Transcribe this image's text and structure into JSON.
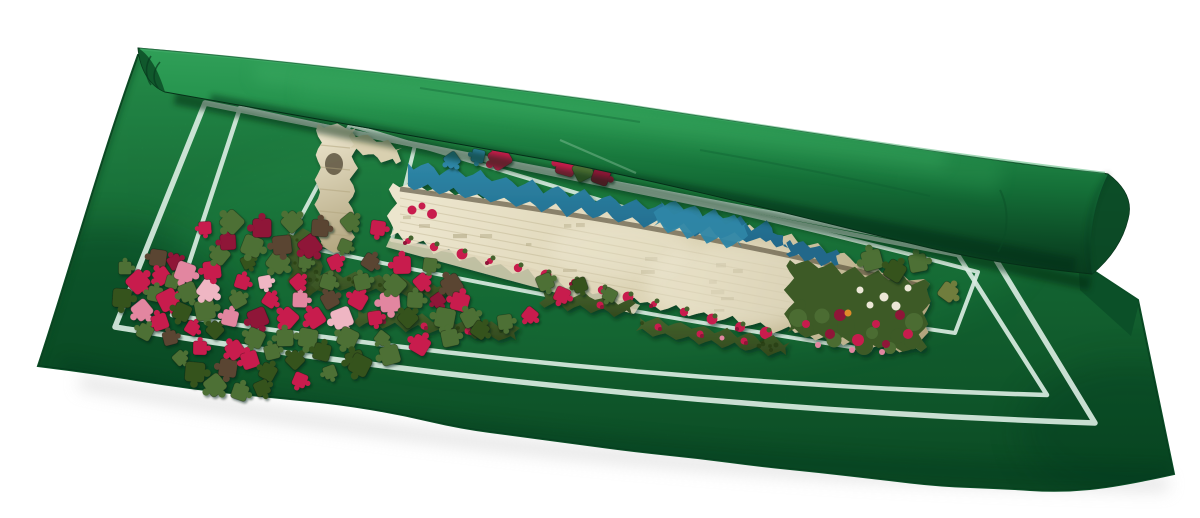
{
  "scene": {
    "kind": "product-photograph",
    "background": "#ffffff",
    "colors": {
      "mat": "#17763a",
      "matLight": "#2aa054",
      "matDark": "#0d5429",
      "matEdge": "#0a4a23",
      "rollTop": "#34a45c",
      "rollMid": "#157038",
      "rollDark": "#06331a",
      "rollShadow": "#04250f",
      "pageShadow": "#cfcfcf",
      "line": "#d9ece1",
      "stoneLight": "#ece5cd",
      "stoneMid": "#d9d0b0",
      "stoneDark": "#b0a37c",
      "brick": "#a89d78",
      "soil": "#4c4430",
      "sky": "#2e86a6",
      "skyDark": "#20688a",
      "foliage": "#44632d",
      "foliageDark": "#32491d",
      "garden": "#3c5a28",
      "flowerRed": "#c81e4e",
      "flowerDeep": "#8f1238",
      "flowerPink": "#e286a0",
      "daisy": "#ece7d6",
      "orange": "#df8b2b",
      "glare": "#f7f3e2",
      "walkway": "#ded5b8",
      "arch": "#5d5440"
    },
    "piece_colors": {
      "red": "#c81e4e",
      "darkred": "#8f1238",
      "pink": "#e286a0",
      "lightpink": "#efb6c3",
      "green": "#4d7034",
      "darkgreen": "#35521f",
      "brown": "#5a4532",
      "olive": "#6f7d3c",
      "blue": "#2e86a6",
      "stone": "#d8cfae"
    },
    "loose_pieces": [
      [
        125,
        268,
        "green"
      ],
      [
        138,
        282,
        "red"
      ],
      [
        122,
        298,
        "darkgreen"
      ],
      [
        142,
        310,
        "pink"
      ],
      [
        158,
        258,
        "brown"
      ],
      [
        162,
        276,
        "red"
      ],
      [
        155,
        294,
        "green"
      ],
      [
        175,
        262,
        "darkred"
      ],
      [
        172,
        282,
        "green"
      ],
      [
        168,
        300,
        "red"
      ],
      [
        185,
        272,
        "pink"
      ],
      [
        188,
        292,
        "green"
      ],
      [
        182,
        312,
        "darkgreen"
      ],
      [
        160,
        322,
        "red"
      ],
      [
        145,
        332,
        "green"
      ],
      [
        170,
        338,
        "brown"
      ],
      [
        192,
        328,
        "red"
      ],
      [
        205,
        310,
        "green"
      ],
      [
        208,
        290,
        "lightpink"
      ],
      [
        212,
        270,
        "red"
      ],
      [
        220,
        255,
        "green"
      ],
      [
        228,
        242,
        "darkred"
      ],
      [
        215,
        330,
        "darkgreen"
      ],
      [
        200,
        348,
        "red"
      ],
      [
        180,
        358,
        "green"
      ],
      [
        195,
        372,
        "darkgreen"
      ],
      [
        215,
        385,
        "green"
      ],
      [
        228,
        368,
        "brown"
      ],
      [
        235,
        350,
        "red"
      ],
      [
        230,
        318,
        "pink"
      ],
      [
        238,
        300,
        "green"
      ],
      [
        242,
        282,
        "red"
      ],
      [
        248,
        262,
        "darkgreen"
      ],
      [
        252,
        246,
        "green"
      ],
      [
        258,
        318,
        "darkred"
      ],
      [
        255,
        338,
        "green"
      ],
      [
        250,
        360,
        "red"
      ],
      [
        268,
        372,
        "darkgreen"
      ],
      [
        272,
        352,
        "green"
      ],
      [
        270,
        300,
        "red"
      ],
      [
        265,
        282,
        "lightpink"
      ],
      [
        278,
        262,
        "green"
      ],
      [
        282,
        245,
        "brown"
      ],
      [
        288,
        318,
        "red"
      ],
      [
        285,
        338,
        "green"
      ],
      [
        295,
        360,
        "darkgreen"
      ],
      [
        300,
        300,
        "pink"
      ],
      [
        298,
        282,
        "red"
      ],
      [
        305,
        262,
        "green"
      ],
      [
        310,
        246,
        "darkred"
      ],
      [
        308,
        338,
        "green"
      ],
      [
        315,
        318,
        "red"
      ],
      [
        322,
        352,
        "darkgreen"
      ],
      [
        330,
        300,
        "brown"
      ],
      [
        328,
        282,
        "green"
      ],
      [
        335,
        262,
        "red"
      ],
      [
        345,
        246,
        "green"
      ],
      [
        342,
        318,
        "lightpink"
      ],
      [
        348,
        338,
        "green"
      ],
      [
        355,
        360,
        "darkgreen"
      ],
      [
        358,
        300,
        "red"
      ],
      [
        362,
        282,
        "green"
      ],
      [
        370,
        262,
        "brown"
      ],
      [
        375,
        318,
        "red"
      ],
      [
        382,
        338,
        "green"
      ],
      [
        390,
        302,
        "pink"
      ],
      [
        395,
        285,
        "green"
      ],
      [
        402,
        265,
        "red"
      ],
      [
        408,
        318,
        "darkgreen"
      ],
      [
        415,
        300,
        "green"
      ],
      [
        422,
        282,
        "red"
      ],
      [
        430,
        265,
        "green"
      ],
      [
        438,
        300,
        "darkred"
      ],
      [
        445,
        318,
        "green"
      ],
      [
        452,
        285,
        "brown"
      ],
      [
        460,
        302,
        "red"
      ],
      [
        470,
        318,
        "green"
      ],
      [
        240,
        392,
        "green"
      ],
      [
        262,
        388,
        "darkgreen"
      ],
      [
        300,
        380,
        "red"
      ],
      [
        330,
        372,
        "green"
      ],
      [
        360,
        365,
        "darkgreen"
      ],
      [
        390,
        355,
        "green"
      ],
      [
        420,
        345,
        "red"
      ],
      [
        450,
        338,
        "green"
      ],
      [
        480,
        330,
        "darkgreen"
      ],
      [
        505,
        322,
        "green"
      ],
      [
        530,
        315,
        "red"
      ],
      [
        205,
        228,
        "red"
      ],
      [
        232,
        222,
        "green"
      ],
      [
        262,
        228,
        "darkred"
      ],
      [
        292,
        222,
        "green"
      ],
      [
        320,
        228,
        "brown"
      ],
      [
        350,
        222,
        "green"
      ],
      [
        378,
        228,
        "red"
      ],
      [
        452,
        160,
        "blue"
      ],
      [
        478,
        156,
        "blue"
      ],
      [
        500,
        158,
        "red"
      ],
      [
        566,
        166,
        "red"
      ],
      [
        583,
        171,
        "green"
      ],
      [
        601,
        176,
        "darkred"
      ],
      [
        545,
        282,
        "green"
      ],
      [
        562,
        295,
        "red"
      ],
      [
        580,
        285,
        "darkgreen"
      ],
      [
        610,
        295,
        "green"
      ],
      [
        872,
        260,
        "green"
      ],
      [
        895,
        271,
        "darkgreen"
      ],
      [
        918,
        263,
        "green"
      ],
      [
        948,
        292,
        "olive"
      ]
    ]
  }
}
